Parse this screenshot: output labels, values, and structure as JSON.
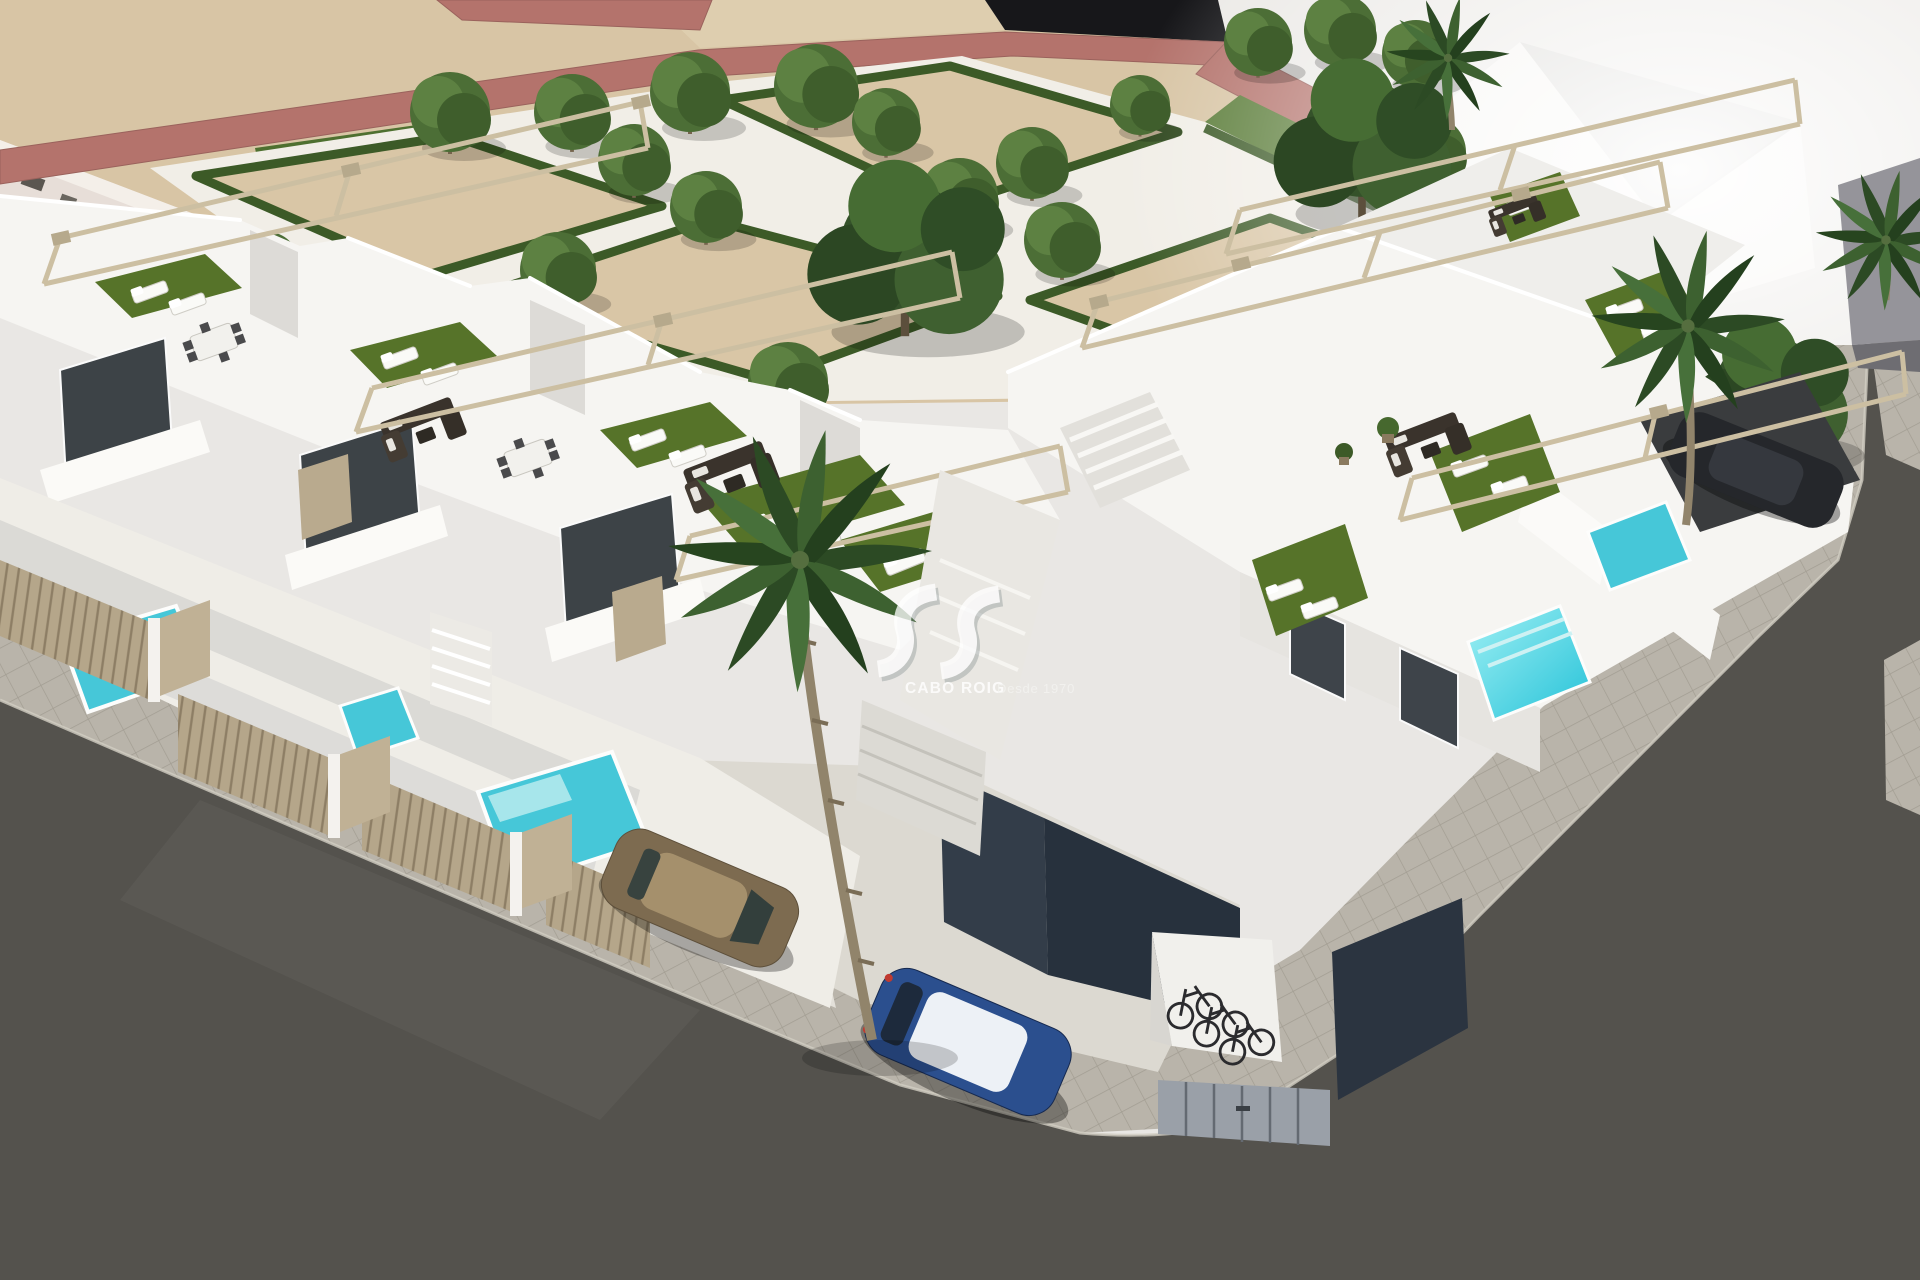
{
  "scene": {
    "type": "3D architectural aerial render",
    "subject": "New-build development of modern white townhouses on a street corner, with rooftop solariums, artificial turf, sun loungers, pergolas, private plunge pools, landscaped park with geometric hedges, palm trees, parked cars and a bicycle shelter",
    "inventory": {
      "townhouse_rows": 2,
      "plunge_pools_visible": 6,
      "vehicles": [
        "brown hatchback",
        "blue hatchback with white roof",
        "dark car under carport"
      ],
      "bicycles": 3,
      "palm_trees": 4,
      "large_trees": 3
    }
  },
  "watermark": {
    "brand": "CABO ROIG",
    "tagline": "Desde 1970",
    "logo": "sv-ribbon-logo"
  },
  "palette": {
    "sky": "#e9e7e4",
    "sand": "#d8c5a5",
    "walkway_red": "#b4736c",
    "park_path": "#f1eee7",
    "hedge": "#3c5a27",
    "turf": "#567329",
    "building_white": "#f6f5f2",
    "building_shade": "#dddbd7",
    "pergola": "#ccbfa2",
    "fence_wood": "#b5a68a",
    "asphalt": "#54524d",
    "sidewalk": "#b9b4aa",
    "parking_concrete": "#dcd9d1",
    "pool": "#46c7d8",
    "car_brown": "#7d6b50",
    "car_blue": "#2b4f8e",
    "car_dark": "#25272b"
  }
}
